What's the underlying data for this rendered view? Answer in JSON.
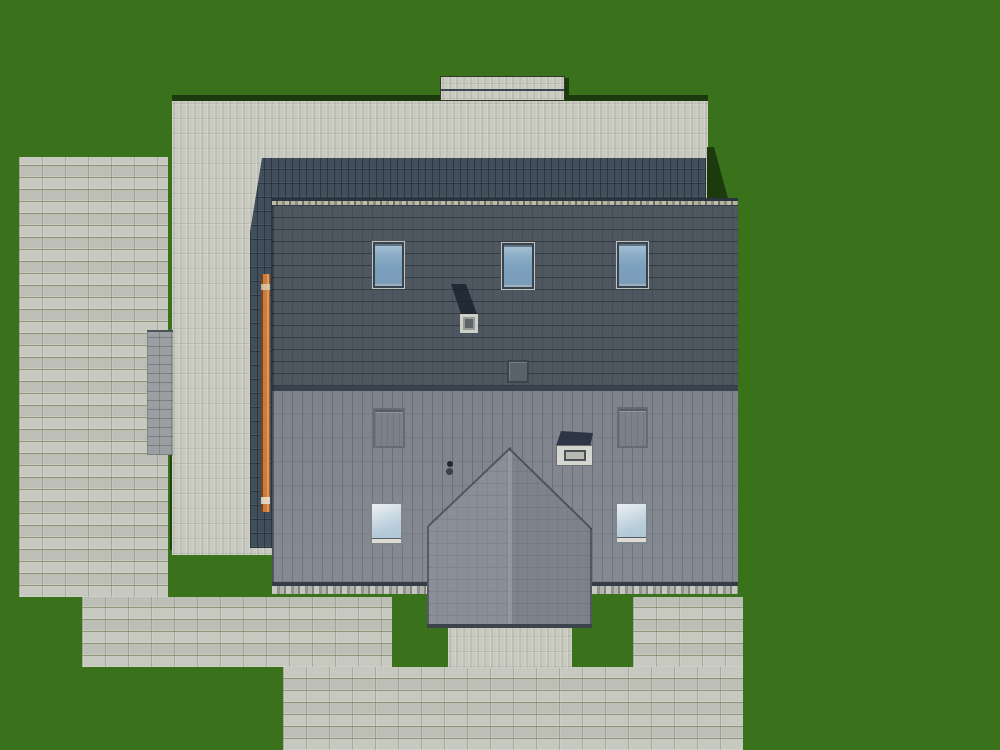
{
  "scene": {
    "type": "3d-architectural-render",
    "view": "top-down-site-plan",
    "description": "Detached house with gable roof seen from directly above: dark upper roof slope with three blue skylights, lighter lower slope with two gray roof windows, two blue skylights, two chimneys and a vent; gabled entrance porch at the bottom; light stacked-tile terrace wrapping the house; running-bond paver plaza and walkways on a green lawn; orange beam along the left roof edge",
    "features": {
      "upper_skylights": 3,
      "lower_skylights": 2,
      "lower_gray_windows": 2,
      "chimneys": 2,
      "roof_vents": 1,
      "vent_pipes": 2
    }
  },
  "colors": {
    "grass": "#3a721c",
    "grass-shadow": "#1d3a0e",
    "paver": "#c7c9c1",
    "terrace": "#c9cbc0",
    "steps": "#9aa0a2",
    "roof-back": "#414e5b",
    "roof-upper": "#4e5760",
    "roof-lower": "#7e838c",
    "porch-left": "#8a8f97",
    "porch-right": "#7d838c",
    "beam-orange": "#c97e3e",
    "beam-orange-dark": "#7a431c",
    "window-frame": "#39434d",
    "skylight-glass": "#89aac4",
    "skylight-glass-light": "#cfdde6",
    "chimney-cap": "#2c3644",
    "chimney-box": "#d5d6d0",
    "vent": "#57626a",
    "dot": "#20262c"
  }
}
